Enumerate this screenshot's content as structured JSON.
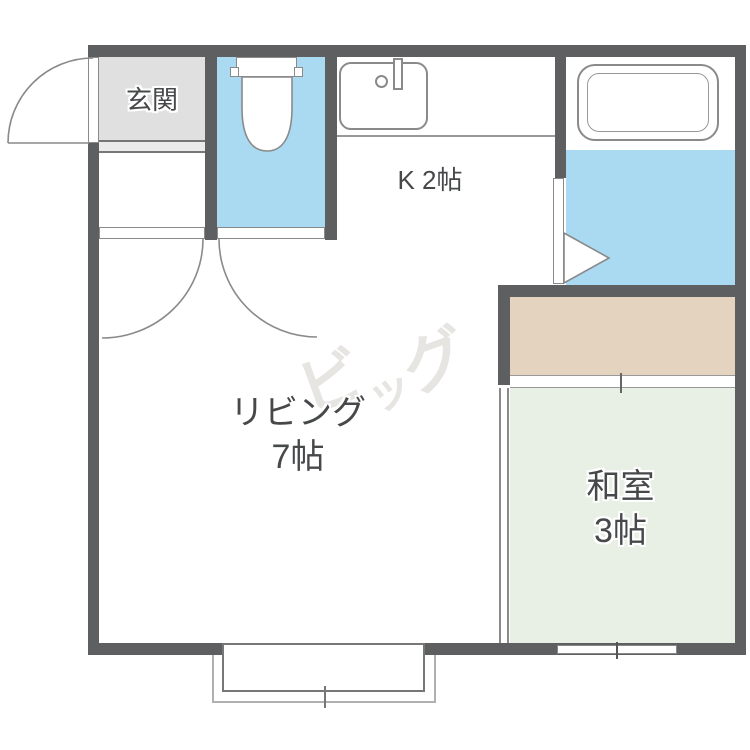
{
  "rooms": {
    "genkan": {
      "label": "玄関"
    },
    "kitchen": {
      "label": "K 2帖"
    },
    "living": {
      "line1": "リビング",
      "line2": "7帖"
    },
    "washitsu": {
      "line1": "和室",
      "line2": "3帖"
    }
  },
  "watermark": {
    "text": "ビッグ",
    "char1": "ビ",
    "char2": "ッ",
    "char3": "グ"
  },
  "colors": {
    "wall": "#5e5f61",
    "water_blue": "#aadaf2",
    "genkan_gray": "#e0e0e0",
    "genkan_step_gray": "#ebebeb",
    "closet_beige": "#e4d4bf",
    "tatami_green": "#e8efe5",
    "label_text": "#47484a",
    "watermark_gray": "#e7e5e2",
    "fixture_line": "#8a8a8a"
  },
  "icons": {
    "entrance_door": "entrance-door-swing-icon",
    "toilet": "toilet-icon",
    "sink": "kitchen-sink-icon",
    "bathtub": "bathtub-icon",
    "bath_door": "folding-door-icon",
    "interior_doors": "door-swing-icon",
    "sliding_door": "sliding-door-icon",
    "window": "window-icon"
  }
}
